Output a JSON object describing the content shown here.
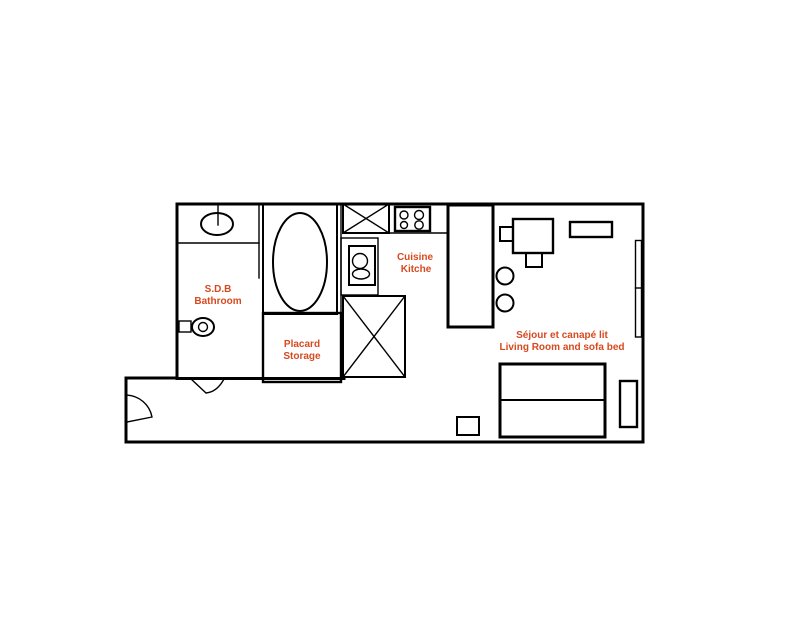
{
  "colors": {
    "label": "#d7491f",
    "wall": "#000000",
    "background": "#ffffff"
  },
  "rooms": {
    "bathroom": {
      "fr": "S.D.B",
      "en": "Bathroom"
    },
    "storage": {
      "fr": "Placard",
      "en": "Storage"
    },
    "kitchen": {
      "fr": "Cuisine",
      "en": "Kitche"
    },
    "living": {
      "fr": "Séjour et canapé lit",
      "en": "Living Room and sofa bed"
    }
  }
}
